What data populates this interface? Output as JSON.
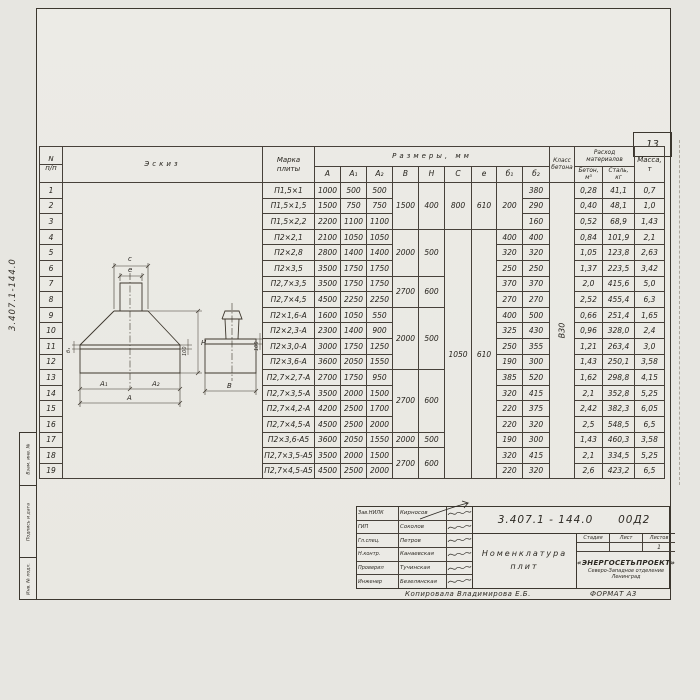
{
  "page": {
    "number": "13"
  },
  "margin": {
    "doc_number": "3.407.1-144.0",
    "stamps": [
      "Взам. инв. №",
      "Подпись и дата",
      "Инв. № подл."
    ]
  },
  "table": {
    "headers": {
      "num_top": "N",
      "num_bot": "п/п",
      "sketch": "Эскиз",
      "marka1": "Марка",
      "marka2": "плиты",
      "razmery": "Размеры, мм",
      "cols": [
        "А",
        "А₁",
        "А₂",
        "В",
        "Н",
        "С",
        "е",
        "б₁",
        "б₂"
      ],
      "klass1": "Класс",
      "klass2": "бетона",
      "rashod1": "Расход",
      "rashod2": "материалов",
      "beton1": "Бетон,",
      "beton2": "м³",
      "stal1": "Сталь,",
      "stal2": "кг",
      "massa1": "Масса,",
      "massa2": "т"
    },
    "concrete_class": "В30",
    "rows": [
      [
        "1",
        {
          "t": "",
          "rs": 19,
          "cls": "sketch"
        },
        "П1,5×1",
        "1000",
        "500",
        "500",
        {
          "t": "1500",
          "rs": 3
        },
        {
          "t": "400",
          "rs": 3
        },
        {
          "t": "800",
          "rs": 3
        },
        {
          "t": "610",
          "rs": 3
        },
        {
          "t": "200",
          "rs": 3
        },
        "380",
        {
          "t": "В30",
          "rs": 19,
          "cls": "rot"
        },
        "0,28",
        "41,1",
        "0,7"
      ],
      [
        "2",
        "П1,5×1,5",
        "1500",
        "750",
        "750",
        "290",
        "0,40",
        "48,1",
        "1,0"
      ],
      [
        "3",
        "П1,5×2,2",
        "2200",
        "1100",
        "1100",
        "160",
        "0,52",
        "68,9",
        "1,43"
      ],
      [
        "4",
        "П2×2,1",
        "2100",
        "1050",
        "1050",
        {
          "t": "2000",
          "rs": 3
        },
        {
          "t": "500",
          "rs": 3
        },
        {
          "t": "1050",
          "rs": 16
        },
        {
          "t": "610",
          "rs": 16
        },
        "400",
        "400",
        "0,84",
        "101,9",
        "2,1"
      ],
      [
        "5",
        "П2×2,8",
        "2800",
        "1400",
        "1400",
        "320",
        "320",
        "1,05",
        "123,8",
        "2,63"
      ],
      [
        "6",
        "П2×3,5",
        "3500",
        "1750",
        "1750",
        "250",
        "250",
        "1,37",
        "223,5",
        "3,42"
      ],
      [
        "7",
        "П2,7×3,5",
        "3500",
        "1750",
        "1750",
        {
          "t": "2700",
          "rs": 2
        },
        {
          "t": "600",
          "rs": 2
        },
        "370",
        "370",
        "2,0",
        "415,6",
        "5,0"
      ],
      [
        "8",
        "П2,7×4,5",
        "4500",
        "2250",
        "2250",
        "270",
        "270",
        "2,52",
        "455,4",
        "6,3"
      ],
      [
        "9",
        "П2×1,6-А",
        "1600",
        "1050",
        "550",
        {
          "t": "2000",
          "rs": 4
        },
        {
          "t": "500",
          "rs": 4
        },
        "400",
        "500",
        "0,66",
        "251,4",
        "1,65"
      ],
      [
        "10",
        "П2×2,3-А",
        "2300",
        "1400",
        "900",
        "325",
        "430",
        "0,96",
        "328,0",
        "2,4"
      ],
      [
        "11",
        "П2×3,0-А",
        "3000",
        "1750",
        "1250",
        "250",
        "355",
        "1,21",
        "263,4",
        "3,0"
      ],
      [
        "12",
        "П2×3,6-А",
        "3600",
        "2050",
        "1550",
        "190",
        "300",
        "1,43",
        "250,1",
        "3,58"
      ],
      [
        "13",
        "П2,7×2,7-А",
        "2700",
        "1750",
        "950",
        {
          "t": "2700",
          "rs": 4
        },
        {
          "t": "600",
          "rs": 4
        },
        "385",
        "520",
        "1,62",
        "298,8",
        "4,15"
      ],
      [
        "14",
        "П2,7×3,5-А",
        "3500",
        "2000",
        "1500",
        "320",
        "415",
        "2,1",
        "352,8",
        "5,25"
      ],
      [
        "15",
        "П2,7×4,2-А",
        "4200",
        "2500",
        "1700",
        "220",
        "375",
        "2,42",
        "382,3",
        "6,05"
      ],
      [
        "16",
        "П2,7×4,5-А",
        "4500",
        "2500",
        "2000",
        "220",
        "320",
        "2,5",
        "548,5",
        "6,5"
      ],
      [
        "17",
        "П2×3,6-А5",
        "3600",
        "2050",
        "1550",
        "2000",
        "500",
        "190",
        "300",
        "1,43",
        "460,3",
        "3,58"
      ],
      [
        "18",
        "П2,7×3,5-А5",
        "3500",
        "2000",
        "1500",
        {
          "t": "2700",
          "rs": 2
        },
        {
          "t": "600",
          "rs": 2
        },
        "320",
        "415",
        "2,1",
        "334,5",
        "5,25"
      ],
      [
        "19",
        "П2,7×4,5-А5",
        "4500",
        "2500",
        "2000",
        "220",
        "320",
        "2,6",
        "423,2",
        "6,5"
      ]
    ]
  },
  "sketch": {
    "labels": {
      "c": "с",
      "e": "е",
      "a1": "А₁",
      "a2": "А₂",
      "a": "А",
      "b": "В",
      "b1": "б₁",
      "h": "Н",
      "d100a": "100",
      "d100b": "100"
    }
  },
  "titleblock": {
    "doc_number": "3.407.1 - 144.0",
    "doc_suffix": "00Д2",
    "title_line1": "Номенклатура",
    "title_line2": "плит",
    "personnel": [
      {
        "role": "Зав.НИЛК",
        "name": "Кирносов"
      },
      {
        "role": "ГИП",
        "name": "Соколов"
      },
      {
        "role": "Гл.спец.",
        "name": "Петров"
      },
      {
        "role": "Н.контр.",
        "name": "Канаевская"
      },
      {
        "role": "Проверил",
        "name": "Тучинская"
      },
      {
        "role": "Инженер",
        "name": "Безелянская"
      }
    ],
    "stage_headers": [
      "Стадия",
      "Лист",
      "Листов"
    ],
    "stage_values": [
      "",
      "",
      "1"
    ],
    "org_name": "«ЭНЕРГОСЕТЬПРОЕКТ»",
    "org_branch": "Северо-Западное отделение",
    "org_city": "Ленинград"
  },
  "footer": {
    "copier": "Копировала  Владимирова Е.Б.",
    "format": "ФОРМАТ А3"
  }
}
